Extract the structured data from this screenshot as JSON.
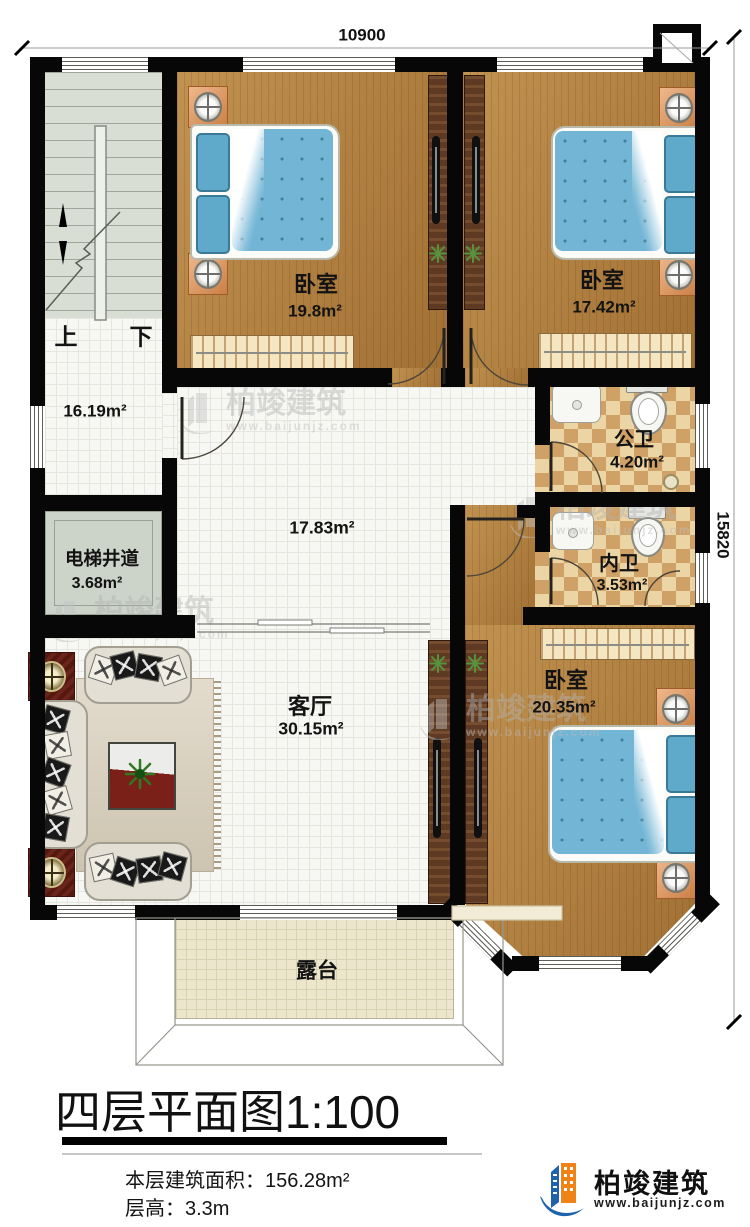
{
  "dimensions": {
    "top": "10900",
    "right": "15820"
  },
  "stairs": {
    "up": "上",
    "down": "下"
  },
  "rooms": {
    "bedroom_top_left": {
      "name": "卧室",
      "area": "19.8m²"
    },
    "bedroom_top_right": {
      "name": "卧室",
      "area": "17.42m²"
    },
    "bedroom_bottom_right": {
      "name": "卧室",
      "area": "20.35m²"
    },
    "stair_hall": {
      "area": "16.19m²"
    },
    "center_hall": {
      "area": "17.83m²"
    },
    "living_room": {
      "name": "客厅",
      "area": "30.15m²"
    },
    "public_bathroom": {
      "name": "公卫",
      "area": "4.20m²"
    },
    "private_bathroom": {
      "name": "内卫",
      "area": "3.53m²"
    },
    "elevator_shaft": {
      "name": "电梯井道",
      "area": "3.68m²"
    },
    "terrace": {
      "name": "露台"
    }
  },
  "title": {
    "name": "四层平面图",
    "scale": "1:100"
  },
  "footer": {
    "floor_area_label": "本层建筑面积：",
    "floor_area_value": "156.28m²",
    "floor_height_label": "层高：",
    "floor_height_value": "3.3m"
  },
  "brand": {
    "name": "柏竣建筑",
    "website": "www.baijunjz.com"
  },
  "colors": {
    "wall": "#070707",
    "wood_floor": "#af7d3c",
    "tile_floor": "#f7f7f4",
    "bath_tile_light": "#ecd5a4",
    "bath_tile_dark": "#cfa166",
    "stair_floor": "#d9ded5",
    "terrace_floor": "#ebe6cc",
    "bed_blue": "#72b5d5",
    "brand_blue": "#1f63ad",
    "brand_orange": "#ef8318"
  }
}
